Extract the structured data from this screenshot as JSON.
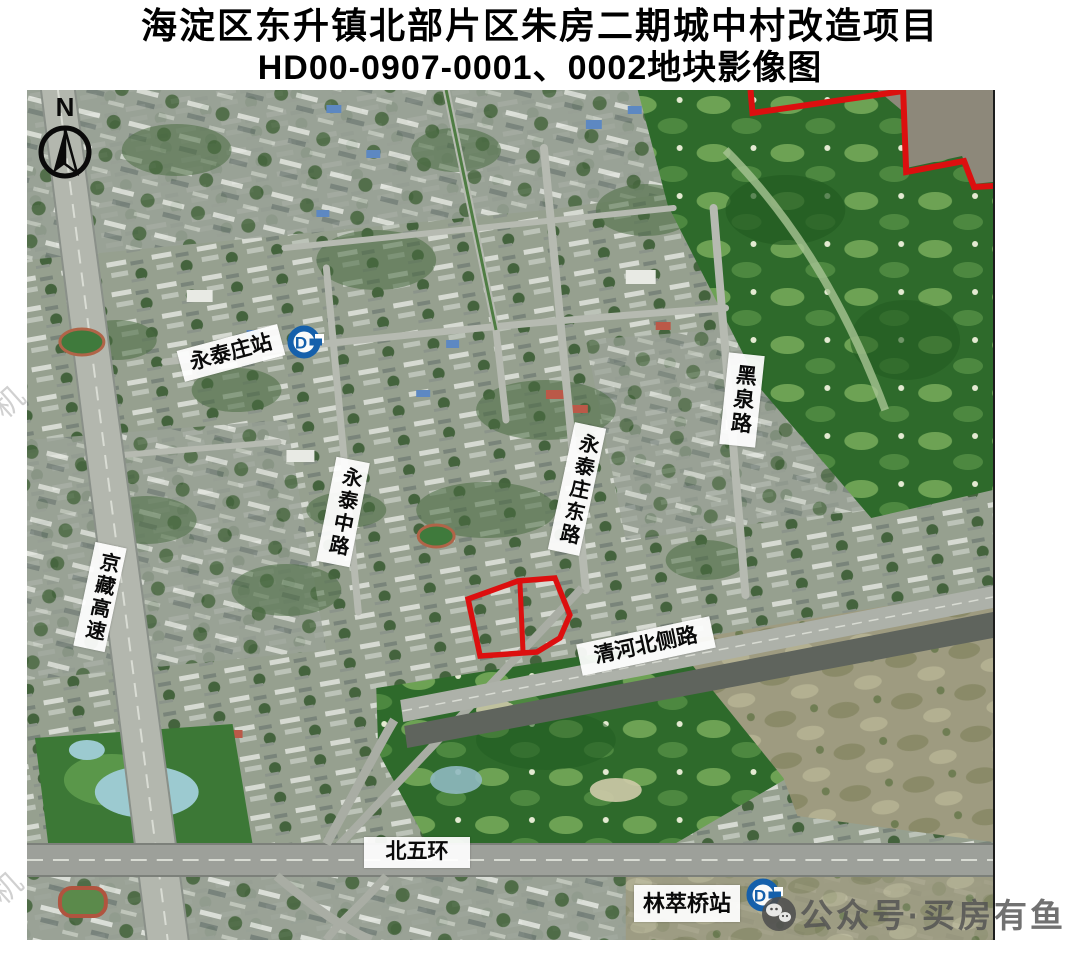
{
  "title": {
    "line1": "海淀区东升镇北部片区朱房二期城中村改造项目",
    "line2": "HD00-0907-0001、0002地块影像图"
  },
  "map": {
    "compass_label": "N",
    "labels": {
      "yongtaizhuang_station": "永泰庄站",
      "heiquan_road": "黑泉路",
      "yongtai_middle_road": "永泰中路",
      "yongtaizhuang_east_road": "永泰庄东路",
      "jingzang_expressway": "京藏高速",
      "qinghe_north_side_road": "清河北侧路",
      "north_fifth_ring_road": "北五环",
      "lincuiqiao_station": "林萃桥站"
    },
    "subway_logo_letter": "D",
    "colors": {
      "parcel_outline": "#dc0f0f",
      "boundary_line": "#dc0f0f",
      "subway_logo_blue": "#1560ab"
    },
    "watermark": {
      "text": "公众号·买房有鱼"
    },
    "faint_fragments": [
      "机",
      "机"
    ]
  }
}
